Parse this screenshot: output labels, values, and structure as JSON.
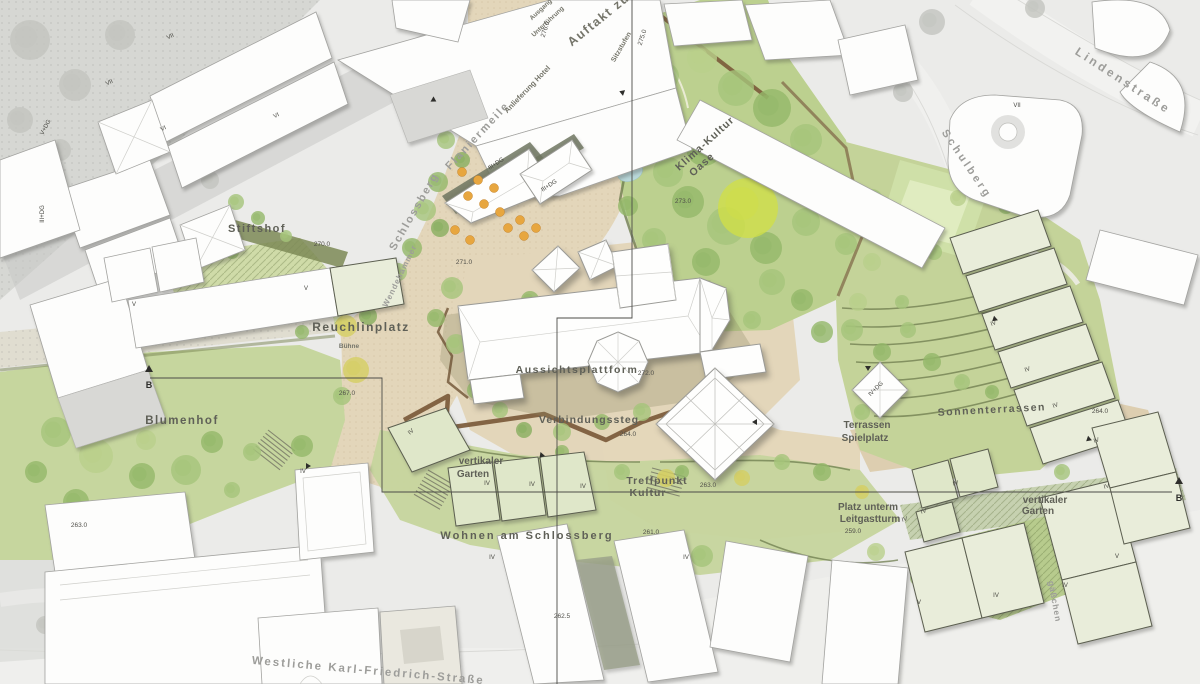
{
  "map": {
    "title": "Schlossberg masterplan site plan",
    "streets": [
      {
        "id": "lindenstrasse",
        "text": "Lindenstraße",
        "x": 1121,
        "y": 84,
        "rot": 33,
        "size": 12,
        "ls": 3
      },
      {
        "id": "schulberg",
        "text": "Schulberg",
        "x": 964,
        "y": 166,
        "rot": 56,
        "size": 11,
        "ls": 3
      },
      {
        "id": "westliche-karl-friedrich-strasse",
        "text": "Westliche Karl-Friedrich-Straße",
        "x": 368,
        "y": 674,
        "rot": 5,
        "size": 11.5,
        "ls": 2
      },
      {
        "id": "schlossberg",
        "text": "Schlossberg",
        "x": 417,
        "y": 213,
        "rot": -60,
        "size": 11,
        "ls": 2
      },
      {
        "id": "wendehammer",
        "text": "Wendehammer",
        "x": 402,
        "y": 277,
        "rot": -64,
        "size": 8,
        "ls": 1
      },
      {
        "id": "flaniermeile",
        "text": "Flaniermeile",
        "x": 480,
        "y": 138,
        "rot": -47,
        "size": 11,
        "ls": 2
      },
      {
        "id": "gaesschen",
        "text": "gäßchen",
        "x": 1052,
        "y": 602,
        "rot": 80,
        "size": 8.5,
        "ls": 1
      }
    ],
    "places": [
      {
        "id": "stiftshof",
        "text": "Stiftshof",
        "x": 257,
        "y": 232,
        "size": 11,
        "ls": 1.5
      },
      {
        "id": "reuchlinplatz",
        "text": "Reuchlinplatz",
        "x": 361,
        "y": 331,
        "size": 12,
        "ls": 1.5
      },
      {
        "id": "blumenhof",
        "text": "Blumenhof",
        "x": 182,
        "y": 424,
        "size": 11.5,
        "ls": 1.5
      },
      {
        "id": "klima-kultur",
        "text": "Klima-Kultur",
        "x": 707,
        "y": 146,
        "rot": -42,
        "size": 10.5,
        "ls": 1
      },
      {
        "id": "klima-kultur-oase",
        "text": "Oase",
        "x": 704,
        "y": 167,
        "rot": -42,
        "size": 10.5,
        "ls": 1
      },
      {
        "id": "aussichtsplattform",
        "text": "Aussichtsplattform",
        "x": 577,
        "y": 373,
        "size": 10.5,
        "ls": 1.5
      },
      {
        "id": "verbindungssteg",
        "text": "Verbindungssteg",
        "x": 589,
        "y": 423,
        "size": 10.5,
        "ls": 1
      },
      {
        "id": "vertikaler-garten-west-1",
        "text": "vertikaler",
        "x": 481,
        "y": 464,
        "size": 10
      },
      {
        "id": "vertikaler-garten-west-2",
        "text": "Garten",
        "x": 473,
        "y": 477,
        "size": 10
      },
      {
        "id": "treffpunkt",
        "text": "Treffpunkt",
        "x": 657,
        "y": 484,
        "size": 10.5,
        "ls": 1
      },
      {
        "id": "treffpunkt-kultur",
        "text": "Kultur",
        "x": 648,
        "y": 496,
        "size": 10.5,
        "ls": 1
      },
      {
        "id": "wohnen-am-schlossberg",
        "text": "Wohnen am Schlossberg",
        "x": 527,
        "y": 539,
        "size": 11,
        "ls": 2
      },
      {
        "id": "terrassen",
        "text": "Terrassen",
        "x": 867,
        "y": 428,
        "size": 10
      },
      {
        "id": "terrassen-spielplatz",
        "text": "Spielplatz",
        "x": 865,
        "y": 441,
        "size": 10
      },
      {
        "id": "sonnenterrassen",
        "text": "Sonnenterrassen",
        "x": 992,
        "y": 413,
        "rot": -3,
        "size": 10.5,
        "ls": 1.5
      },
      {
        "id": "platz-unterm",
        "text": "Platz unterm",
        "x": 868,
        "y": 510,
        "size": 10
      },
      {
        "id": "leitgastturm",
        "text": "Leitgastturm",
        "x": 870,
        "y": 522,
        "size": 10
      },
      {
        "id": "vertikaler-garten-ost-1",
        "text": "vertikaler",
        "x": 1045,
        "y": 503,
        "size": 10
      },
      {
        "id": "vertikaler-garten-ost-2",
        "text": "Garten",
        "x": 1038,
        "y": 514,
        "size": 10
      }
    ],
    "annotations": [
      {
        "id": "auftakt-zum",
        "text": "Auftakt zum",
        "x": 606,
        "y": 19,
        "rot": -39,
        "size": 12.5,
        "ls": 1.5
      },
      {
        "id": "sitzstufen",
        "text": "Sitzstufen",
        "x": 623,
        "y": 48,
        "rot": -60,
        "size": 7
      },
      {
        "id": "ausgang",
        "text": "Ausgang",
        "x": 542,
        "y": 11,
        "rot": -43,
        "size": 6.5
      },
      {
        "id": "unterfuehrung",
        "text": "Unterführung",
        "x": 549,
        "y": 23,
        "rot": -43,
        "size": 6.5
      },
      {
        "id": "anlieferung-hotel",
        "text": "Anlieferung Hotel",
        "x": 529,
        "y": 91,
        "rot": -46,
        "size": 7.5
      },
      {
        "id": "buehne",
        "text": "Bühne",
        "x": 349,
        "y": 348,
        "size": 6.5
      }
    ],
    "elevations": [
      {
        "text": "276.0",
        "x": 547,
        "y": 30,
        "rot": -72
      },
      {
        "text": "275.0",
        "x": 644,
        "y": 38,
        "rot": -72
      },
      {
        "text": "273.0",
        "x": 683,
        "y": 203
      },
      {
        "text": "271.0",
        "x": 464,
        "y": 264
      },
      {
        "text": "270.0",
        "x": 322,
        "y": 246
      },
      {
        "text": "272.0",
        "x": 646,
        "y": 375
      },
      {
        "text": "267.0",
        "x": 347,
        "y": 395
      },
      {
        "text": "264.0",
        "x": 628,
        "y": 436
      },
      {
        "text": "264.0",
        "x": 1100,
        "y": 413
      },
      {
        "text": "263.0",
        "x": 708,
        "y": 487
      },
      {
        "text": "263.0",
        "x": 79,
        "y": 527
      },
      {
        "text": "262.5",
        "x": 562,
        "y": 618
      },
      {
        "text": "261.0",
        "x": 651,
        "y": 534
      },
      {
        "text": "259.0",
        "x": 853,
        "y": 533
      }
    ],
    "storeys": [
      {
        "text": "VII",
        "x": 171,
        "y": 38,
        "rot": -25
      },
      {
        "text": "VII",
        "x": 110,
        "y": 84,
        "rot": -25
      },
      {
        "text": "V+DG",
        "x": 47,
        "y": 128,
        "rot": -62
      },
      {
        "text": "VI",
        "x": 164,
        "y": 130,
        "rot": -25
      },
      {
        "text": "VI",
        "x": 277,
        "y": 117,
        "rot": -25
      },
      {
        "text": "III+DG",
        "x": 44,
        "y": 214,
        "rot": -90
      },
      {
        "text": "V",
        "x": 134,
        "y": 306
      },
      {
        "text": "V",
        "x": 306,
        "y": 290
      },
      {
        "text": "III+DG",
        "x": 497,
        "y": 165,
        "rot": -33
      },
      {
        "text": "III+DG",
        "x": 550,
        "y": 187,
        "rot": -33
      },
      {
        "text": "VII",
        "x": 1017,
        "y": 107
      },
      {
        "text": "IV+DG",
        "x": 877,
        "y": 390,
        "rot": -45
      },
      {
        "text": "IV",
        "x": 994,
        "y": 325,
        "rot": -20
      },
      {
        "text": "IV",
        "x": 1028,
        "y": 371,
        "rot": -20
      },
      {
        "text": "IV",
        "x": 1056,
        "y": 407,
        "rot": -20
      },
      {
        "text": "IV",
        "x": 1097,
        "y": 442,
        "rot": -20
      },
      {
        "text": "IV",
        "x": 1107,
        "y": 488,
        "rot": -15
      },
      {
        "text": "IV",
        "x": 956,
        "y": 485,
        "rot": -15
      },
      {
        "text": "IV",
        "x": 924,
        "y": 513,
        "rot": -15
      },
      {
        "text": "IV",
        "x": 905,
        "y": 521,
        "rot": -15
      },
      {
        "text": "V",
        "x": 1117,
        "y": 558
      },
      {
        "text": "IV",
        "x": 1065,
        "y": 587
      },
      {
        "text": "IV",
        "x": 996,
        "y": 597
      },
      {
        "text": "V",
        "x": 919,
        "y": 604
      },
      {
        "text": "IV",
        "x": 487,
        "y": 485
      },
      {
        "text": "IV",
        "x": 532,
        "y": 486
      },
      {
        "text": "IV",
        "x": 583,
        "y": 488
      },
      {
        "text": "IV",
        "x": 412,
        "y": 433,
        "rot": -40
      },
      {
        "text": "IV",
        "x": 303,
        "y": 473
      },
      {
        "text": "IV",
        "x": 492,
        "y": 559
      },
      {
        "text": "IV",
        "x": 686,
        "y": 559
      }
    ],
    "sections": [
      {
        "label": "B",
        "tx": 149,
        "ty": 372,
        "x": 149,
        "y": 384
      },
      {
        "label": "B",
        "tx": 1179,
        "ty": 484,
        "x": 1179,
        "y": 497
      }
    ]
  },
  "colors": {
    "plaza_tan": "#e3d6ba",
    "park_green": "#bcd08f",
    "lawn_green": "#c6d69e",
    "hedge_green": "#7c8a56",
    "steg_brown": "#7b5a3a",
    "new_building": "#e9edda",
    "context_building": "#fdfdfc",
    "parasol_orange": "#e7a63f",
    "water_blue": "#b9d8da"
  }
}
